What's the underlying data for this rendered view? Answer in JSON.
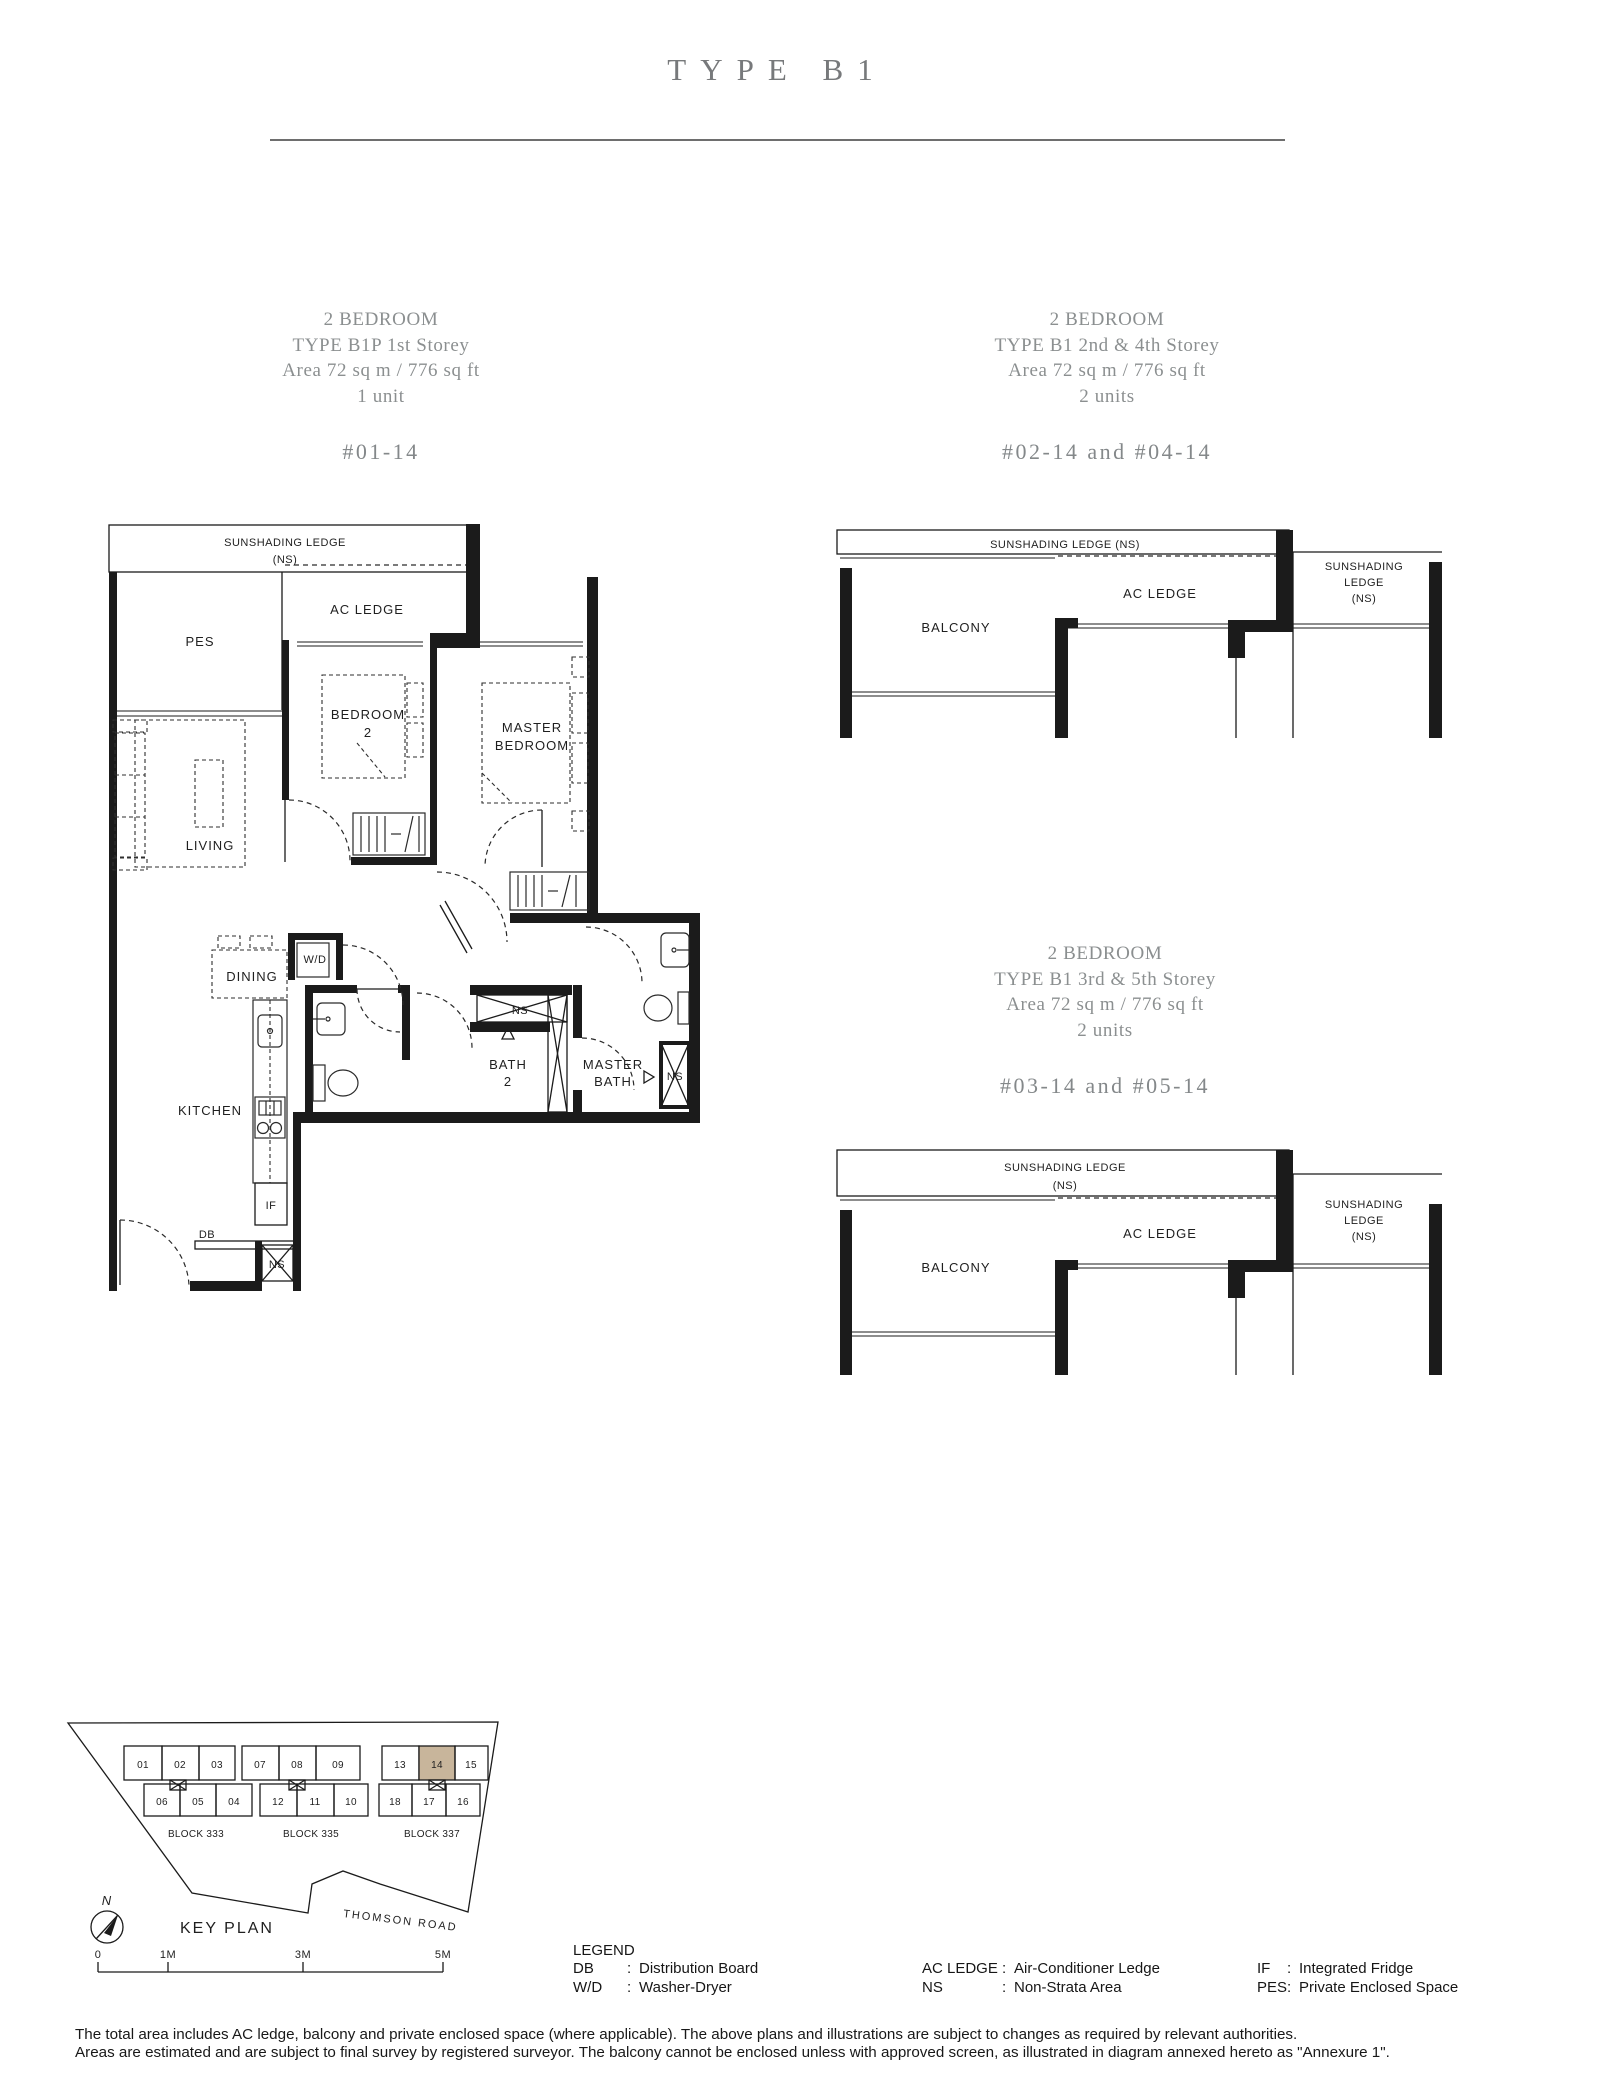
{
  "doc": {
    "title": "TYPE B1"
  },
  "headings": {
    "b1p": {
      "l1": "2 BEDROOM",
      "l2": "TYPE B1P 1st Storey",
      "l3": "Area 72 sq m / 776 sq ft",
      "l4": "1 unit",
      "units": "#01-14"
    },
    "b1_24": {
      "l1": "2 BEDROOM",
      "l2": "TYPE B1 2nd & 4th Storey",
      "l3": "Area 72 sq m / 776 sq ft",
      "l4": "2 units",
      "units": "#02-14 and #04-14"
    },
    "b1_35": {
      "l1": "2 BEDROOM",
      "l2": "TYPE B1 3rd & 5th Storey",
      "l3": "Area 72 sq m / 776 sq ft",
      "l4": "2 units",
      "units": "#03-14 and #05-14"
    }
  },
  "fp": {
    "sunshading": "SUNSHADING LEDGE",
    "ns_paren": "(NS)",
    "sunshading_ns": "SUNSHADING LEDGE (NS)",
    "sunshading_w": "SUNSHADING",
    "ledge_w": "LEDGE",
    "ac_ledge": "AC LEDGE",
    "pes": "PES",
    "bedroom": "BEDROOM",
    "two": "2",
    "master": "MASTER",
    "bedroom_w": "BEDROOM",
    "bath": "BATH",
    "living": "LIVING",
    "dining": "DINING",
    "kitchen": "KITCHEN",
    "wd": "W/D",
    "ns": "NS",
    "if_label": "IF",
    "db": "DB",
    "balcony": "BALCONY"
  },
  "keyplan": {
    "title": "KEY PLAN",
    "north": "N",
    "road": "THOMSON ROAD",
    "highlighted_unit": "14",
    "highlight_color": "#c8b59b",
    "blocks": [
      {
        "name": "BLOCK 333",
        "top": [
          "01",
          "02",
          "03"
        ],
        "bottom": [
          "06",
          "05",
          "04"
        ]
      },
      {
        "name": "BLOCK 335",
        "top": [
          "07",
          "08",
          "09"
        ],
        "bottom": [
          "12",
          "11",
          "10"
        ]
      },
      {
        "name": "BLOCK 337",
        "top": [
          "13",
          "14",
          "15"
        ],
        "bottom": [
          "18",
          "17",
          "16"
        ]
      }
    ],
    "scale": [
      "0",
      "1M",
      "3M",
      "5M"
    ]
  },
  "legend": {
    "title": "LEGEND",
    "colon": ":",
    "entries": [
      {
        "term": "DB",
        "def": "Distribution Board"
      },
      {
        "term": "W/D",
        "def": "Washer-Dryer"
      },
      {
        "term": "AC LEDGE",
        "def": "Air-Conditioner Ledge"
      },
      {
        "term": "NS",
        "def": "Non-Strata Area"
      },
      {
        "term": "IF",
        "def": "Integrated Fridge"
      },
      {
        "term": "PES",
        "def": "Private Enclosed Space"
      }
    ]
  },
  "disclaimer": {
    "line1": "The total area includes AC ledge, balcony and private enclosed space (where applicable). The above plans and illustrations are subject to changes as required by relevant authorities.",
    "line2": "Areas are estimated and are subject to final survey by registered surveyor. The balcony cannot be enclosed unless with approved screen, as illustrated in diagram annexed hereto as \"Annexure 1\"."
  }
}
